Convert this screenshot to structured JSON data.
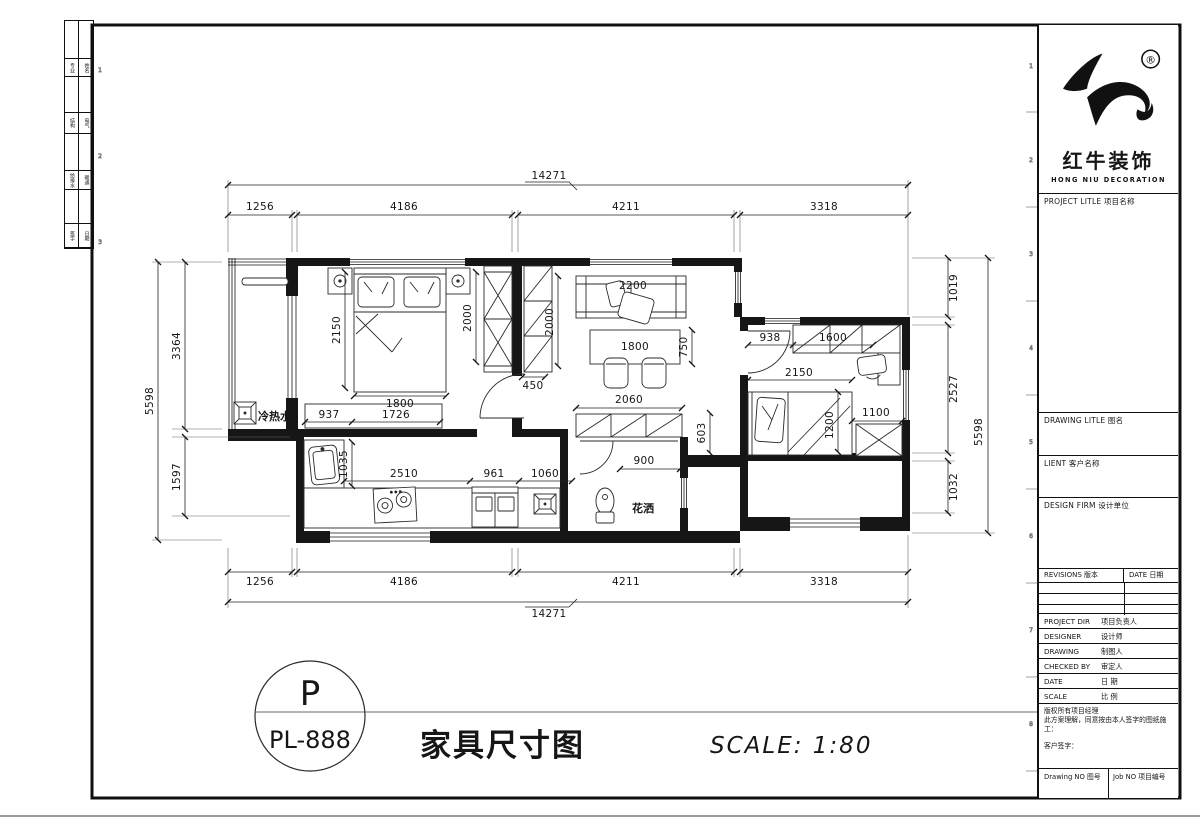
{
  "sheet": {
    "bg": "#ffffff",
    "line_color": "#161616",
    "fold_marks": [
      "1",
      "2",
      "3",
      "4",
      "5",
      "6",
      "7",
      "8"
    ],
    "strip_marks": [
      "1",
      "2",
      "3"
    ]
  },
  "signoff_strip": {
    "rows": [
      {
        "left": "专业",
        "right": "姓名"
      },
      {
        "left": "结构",
        "right": "电气"
      },
      {
        "left": "给排水",
        "right": "暖通"
      },
      {
        "left": "签字",
        "right": "日期"
      }
    ]
  },
  "brand": {
    "registered": "®",
    "name_cn": "红牛装饰",
    "name_en": "HONG NIU DECORATION"
  },
  "title_block": {
    "project_title_label": "PROJECT LITLE 项目名称",
    "drawing_title_label": "DRAWING LITLE 图名",
    "client_label": "LIENT 客户名称",
    "design_firm_label": "DESIGN FIRM 设计单位",
    "revisions_label": "REVISIONS 版本",
    "revisions_date_label": "DATE 日期",
    "rows": [
      {
        "en": "PROJECT DIR",
        "cn": "项目负责人"
      },
      {
        "en": "DESIGNER",
        "cn": "设计师"
      },
      {
        "en": "DRAWING",
        "cn": "制图人"
      },
      {
        "en": "CHECKED BY",
        "cn": "审定人"
      },
      {
        "en": "DATE",
        "cn": "日 期"
      },
      {
        "en": "SCALE",
        "cn": "比 例"
      }
    ],
    "note_line1": "版权所有项目经理",
    "note_line2": "此方案理解，同意按由本人签字的图纸施工：",
    "note_line3": "客户签字：",
    "drawing_no_label": "Drawing NO 图号",
    "job_no_label": "Job NO 项目编号"
  },
  "footer": {
    "badge_letter": "P",
    "badge_number": "PL-888",
    "drawing_title": "家具尺寸图",
    "scale_text": "SCALE: 1:80"
  },
  "plan": {
    "room_labels": {
      "cold_hot_water": "冷热水",
      "shower": "花洒"
    },
    "dims": {
      "top_total": "14271",
      "top_segments": [
        "1256",
        "4186",
        "4211",
        "3318"
      ],
      "bottom_segments": [
        "1256",
        "4186",
        "4211",
        "3318"
      ],
      "bottom_total": "14271",
      "left_outer": "5598",
      "left_segments": [
        "3364",
        "1597"
      ],
      "right_segments": [
        "1019",
        "2527",
        "1032"
      ],
      "right_outer": "5598",
      "master_bed_width": "2150",
      "master_bed_length": "1800",
      "closet_left_depth": "2000",
      "closet_right_depth": "2000",
      "closet_niche": "450",
      "sofa_width": "2200",
      "dining_table_length": "1800",
      "dining_table_depth": "750",
      "bench_a": "937",
      "bench_b": "1726",
      "hall_cabinet_width": "2060",
      "hall_offset": "603",
      "bath_width": "900",
      "bed2_shelf_a": "938",
      "bed2_shelf_b": "1600",
      "bed2_length": "2150",
      "bed2_width": "1200",
      "bed2_cabinet": "1100",
      "kitchen_counter_depth": "1035",
      "kitchen_run_a": "2510",
      "kitchen_run_b": "961",
      "kitchen_run_c": "1060"
    }
  }
}
